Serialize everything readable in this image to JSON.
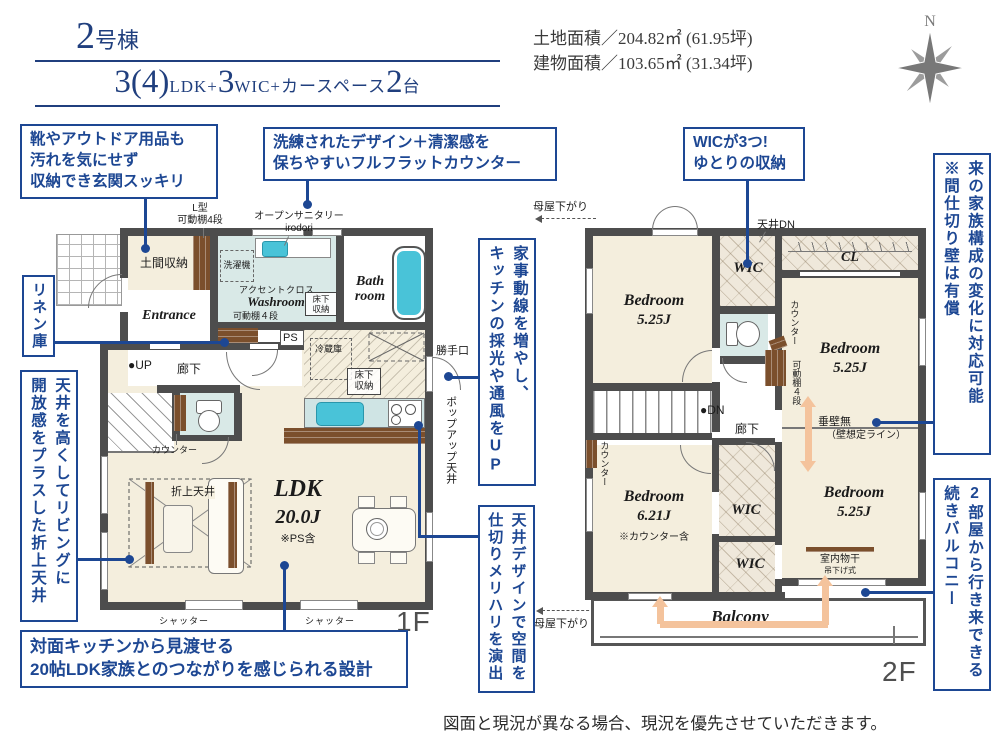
{
  "header": {
    "title_big": "2",
    "title_small": "号棟",
    "sub_b1": "3(4)",
    "sub_s1": "LDK+",
    "sub_b2": "3",
    "sub_s2": "WIC+カースペース",
    "sub_b3": "2",
    "sub_s3": "台",
    "land_area": "土地面積／204.82㎡ (61.95坪)",
    "building_area": "建物面積／103.65㎡ (31.34坪)",
    "north": "N"
  },
  "callouts": {
    "genkan": "靴やアウトドア用品も\n汚れを気にせず\n収納でき玄関スッキリ",
    "counter": "洗練されたデザイン＋清潔感を\n保ちやすいフルフラットカウンター",
    "wic": "WICが3つ!\nゆとりの収納",
    "partition": "来の家族構成の変化に対応可能\n※間仕切り壁は有償",
    "linen": "リネン庫",
    "oriage": "天井を高くしてリビングに\n開放感をプラスした折上天井",
    "taimen": "対面キッチンから見渡せる\n20帖LDK家族とのつながりを感じられる設計",
    "kaji": "家事動線を増やし、\nキッチンの採光や通風をUP",
    "tenjo": "天井デザインで空間を\n仕切りメリハリを演出",
    "tsuzuki": "2部屋から行き来できる\n続きバルコニー"
  },
  "plan1f": {
    "floor": "1F",
    "lshelf": "L型\n可動棚4段",
    "opensanitary": "オープンサニタリー\nirodori",
    "doma": "土間収納",
    "entrance": "Entrance",
    "sentakuki": "洗濯機",
    "accent": "アクセントクロス",
    "washroom": "Washroom",
    "yukashita": "床下\n収納",
    "kadou4": "可動棚４段",
    "ps": "PS",
    "bath": "Bath\nroom",
    "reizouko": "冷蔵庫",
    "katteguchi": "勝手口",
    "popup": "ポップアップ天井",
    "up": "●UP",
    "rouka": "廊下",
    "counter": "カウンター",
    "oriage": "折上天井",
    "ldk": "LDK",
    "ldk_size": "20.0J",
    "ldk_note": "※PS含",
    "shutter": "シャッター"
  },
  "plan2f": {
    "floor": "2F",
    "moya": "母屋下がり",
    "tenjo_dn": "天井DN",
    "wic": "WIC",
    "cl": "CL",
    "bed_name": "Bedroom",
    "bed1_size": "5.25J",
    "bed2_size": "5.25J",
    "bed3_size": "5.25J",
    "bed4_size": "6.21J",
    "bed4_note": "※カウンター含",
    "counter": "カウンター",
    "kadou4": "可動棚４段",
    "tarekabe": "垂壁無",
    "kabesotei": "（壁想定ライン）",
    "dn": "●DN",
    "rouka": "廊下",
    "monohoshi": "室内物干",
    "tsurisage": "吊下げ式",
    "balcony": "Balcony"
  },
  "disclaimer": "図面と現況が異なる場合、現況を優先させていただきます。"
}
